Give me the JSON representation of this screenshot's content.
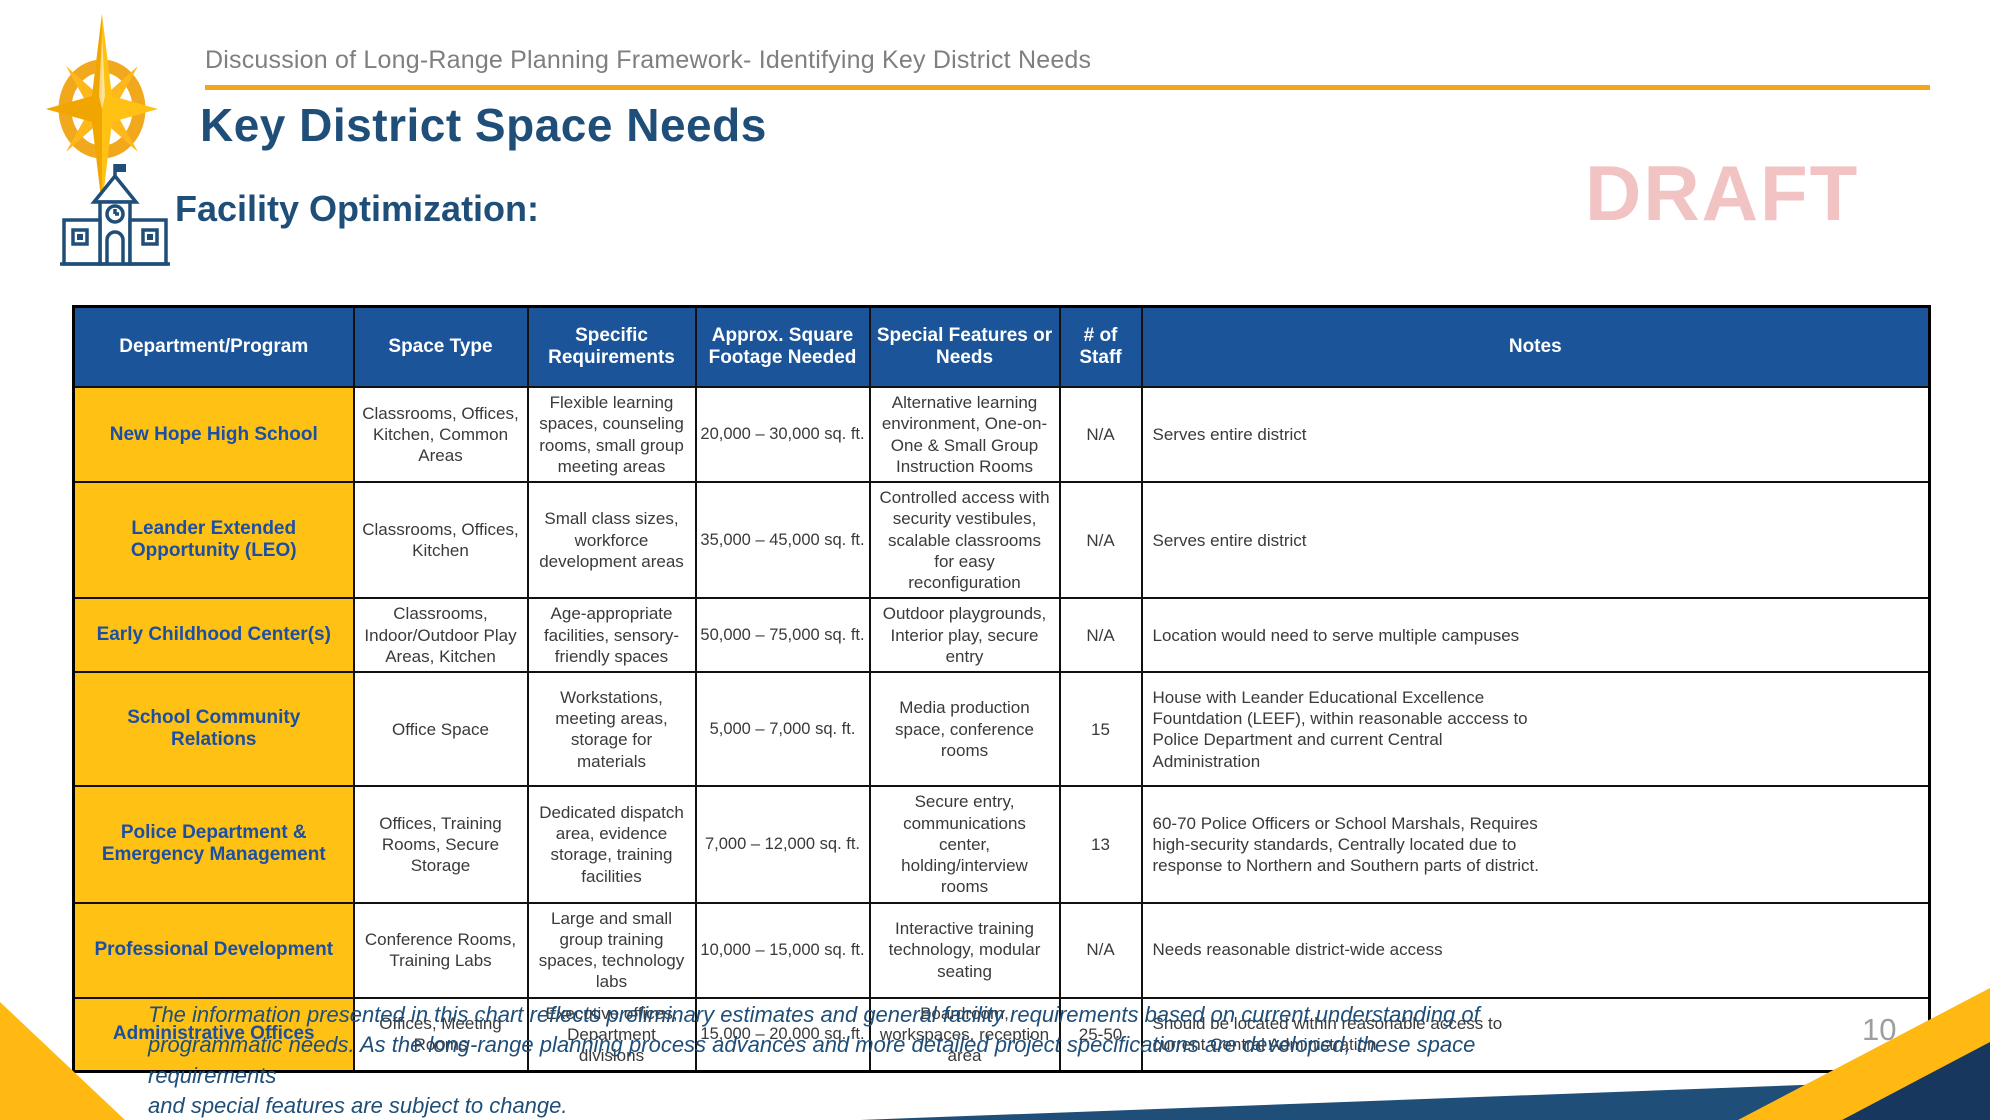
{
  "header": {
    "breadcrumb": "Discussion of Long-Range Planning Framework- Identifying Key District Needs",
    "title": "Key District Space Needs",
    "watermark": "DRAFT",
    "section_heading": "Facility Optimization:"
  },
  "icons": {
    "compass_logo": "compass-rose-logo",
    "school_icon": "schoolhouse-icon"
  },
  "colors": {
    "header_blue": "#1B5499",
    "gold": "#FFC214",
    "accent_gold_line": "#F2A71B",
    "title_blue": "#1F4E79",
    "draft_pink": "#F2C3C3",
    "corner_navy": "#17375E",
    "body_text": "#3a3a3a"
  },
  "table": {
    "columns": [
      "Department/Program",
      "Space Type",
      "Specific Requirements",
      "Approx. Square Footage Needed",
      "Special Features or Needs",
      "# of Staff",
      "Notes"
    ],
    "rows": [
      {
        "department": "New Hope High School",
        "space_type": "Classrooms, Offices, Kitchen, Common Areas",
        "specific_requirements": "Flexible learning spaces, counseling rooms, small group meeting areas",
        "square_footage": "20,000 – 30,000 sq. ft.",
        "special_features": "Alternative learning environment, One-on-One & Small Group Instruction Rooms",
        "staff": "N/A",
        "notes": "Serves entire district"
      },
      {
        "department": "Leander Extended Opportunity (LEO)",
        "space_type": "Classrooms, Offices, Kitchen",
        "specific_requirements": "Small class sizes, workforce development areas",
        "square_footage": "35,000 – 45,000 sq. ft.",
        "special_features": "Controlled access with security vestibules, scalable classrooms for easy reconfiguration",
        "staff": "N/A",
        "notes": "Serves entire district"
      },
      {
        "department": "Early Childhood Center(s)",
        "space_type": "Classrooms, Indoor/Outdoor Play Areas, Kitchen",
        "specific_requirements": "Age-appropriate facilities, sensory-friendly spaces",
        "square_footage": "50,000 – 75,000 sq. ft.",
        "special_features": "Outdoor playgrounds, Interior play, secure entry",
        "staff": "N/A",
        "notes": "Location would need to serve multiple campuses"
      },
      {
        "department": "School Community Relations",
        "space_type": "Office Space",
        "specific_requirements": "Workstations, meeting areas, storage for materials",
        "square_footage": "5,000 – 7,000 sq. ft.",
        "special_features": "Media production space, conference rooms",
        "staff": "15",
        "notes": "House with Leander Educational Excellence\nFountdation (LEEF), within reasonable acccess to\nPolice Department and current Central\nAdministration"
      },
      {
        "department": "Police Department & Emergency Management",
        "space_type": "Offices, Training Rooms, Secure Storage",
        "specific_requirements": "Dedicated dispatch area, evidence storage, training facilities",
        "square_footage": "7,000 – 12,000 sq. ft.",
        "special_features": "Secure entry, communications center, holding/interview rooms",
        "staff": "13",
        "notes": "60-70 Police Officers or School Marshals, Requires\nhigh-security standards, Centrally located due to\nresponse to Northern and Southern parts of district."
      },
      {
        "department": "Professional Development",
        "space_type": "Conference Rooms, Training Labs",
        "specific_requirements": "Large and small group training spaces, technology labs",
        "square_footage": "10,000 – 15,000 sq. ft.",
        "special_features": "Interactive training technology, modular seating",
        "staff": "N/A",
        "notes": "Needs reasonable district-wide access"
      },
      {
        "department": "Administrative Offices",
        "space_type": "Offices, Meeting Rooms",
        "specific_requirements": "Executive offices, Department divisions",
        "square_footage": "15,000 – 20,000 sq. ft.",
        "special_features": "Boardroom, workspaces, reception area",
        "staff": "25-50",
        "notes": "Should be located within reasonable access to\ncurrent Central Administration"
      }
    ]
  },
  "footer": {
    "disclaimer": "The information presented in this chart reflects preliminary estimates and general facility requirements based on current understanding of\nprogrammatic needs. As the long-range planning process advances and more detailed project specifications are developed, these space requirements\nand special features are subject to change.",
    "page_number": "10"
  }
}
